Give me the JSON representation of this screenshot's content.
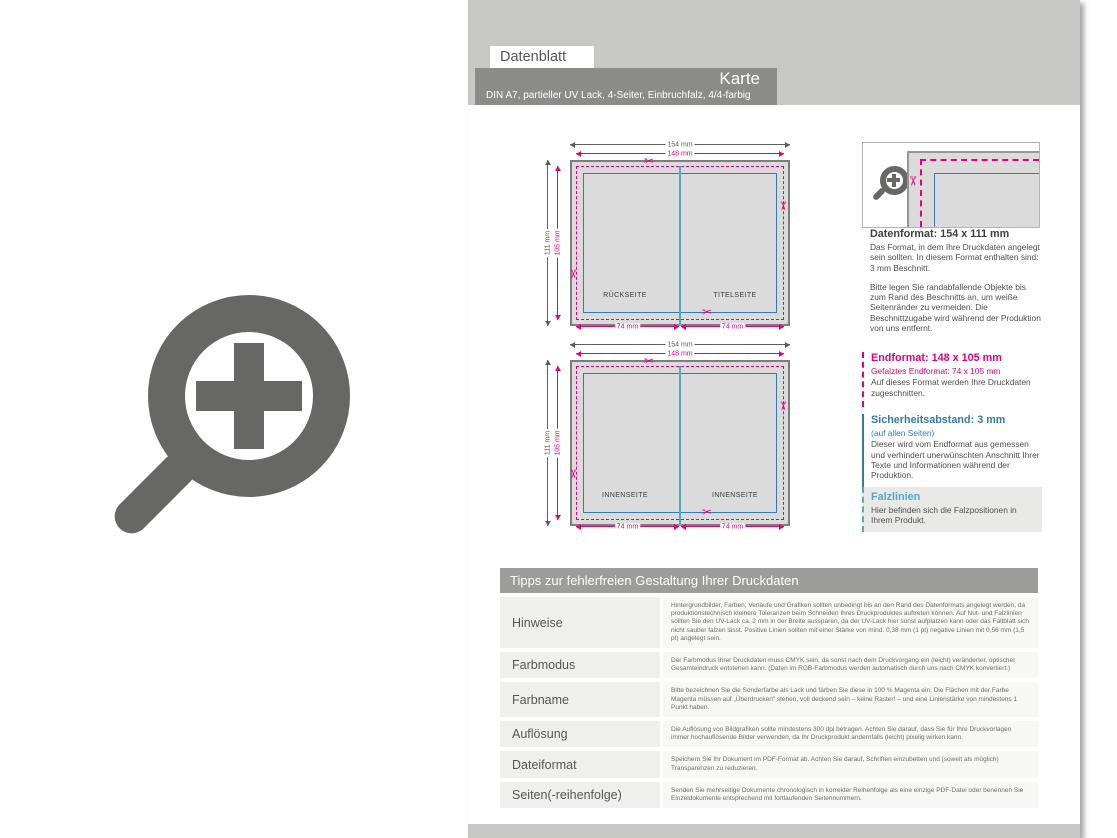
{
  "header": {
    "tab": "Datenblatt",
    "title": "Karte",
    "subtitle": "DIN A7, partieller UV Lack, 4-Seiter, Einbruchfalz, 4/4-farbig"
  },
  "icons": {
    "scissors": "✂"
  },
  "colors": {
    "magenta": "#e5007d",
    "safety_blue": "#3579b8",
    "fold_blue": "#54a7cb",
    "band_gray": "#c7c7c6",
    "header_gray": "#8b8b8a",
    "icon_gray": "#676766"
  },
  "diagrams": [
    {
      "dim_outer_w": "154 mm",
      "dim_inner_w": "148 mm",
      "dim_outer_h": "111 mm",
      "dim_inner_h": "105 mm",
      "dim_half_left": "74 mm",
      "dim_half_right": "74 mm",
      "label_left": "RÜCKSEITE",
      "label_right": "TITELSEITE"
    },
    {
      "dim_outer_w": "154 mm",
      "dim_inner_w": "148 mm",
      "dim_outer_h": "111 mm",
      "dim_inner_h": "105 mm",
      "dim_half_left": "74 mm",
      "dim_half_right": "74 mm",
      "label_left": "INNENSEITE",
      "label_right": "INNENSEITE"
    }
  ],
  "info": {
    "datenformat": {
      "heading": "Datenformat: 154 x 111 mm",
      "p1": "Das Format, in dem Ihre Druckdaten angelegt sein sollten. In diesem Format enthalten sind: 3 mm Beschnitt.",
      "p2": "Bitte legen Sie randabfallende Objekte bis zum Rand des Beschnitts an, um weiße Seitenränder zu vermeiden. Die Beschnittzugabe wird während der Produktion von uns entfernt."
    },
    "endformat": {
      "heading": "Endformat: 148 x 105 mm",
      "sub": "Gefalztes Endformat: 74 x 105 mm",
      "body": "Auf dieses Format werden Ihre Druckdaten zugeschnitten."
    },
    "sicherheitsabstand": {
      "heading": "Sicherheitsabstand: 3 mm",
      "sub": "(auf allen Seiten)",
      "body": "Dieser wird vom Endformat aus gemessen und verhindert unerwünschten Anschnitt Ihrer Texte und Informationen während der Produktion."
    },
    "falzlinien": {
      "heading": "Falzlinien",
      "body": "Hier befinden sich die Falzpositionen in Ihrem Produkt."
    }
  },
  "tips": {
    "title": "Tipps zur fehlerfreien Gestaltung Ihrer Druckdaten",
    "rows": [
      {
        "label": "Hinweise",
        "text": "Hintergrundbilder, Farben, Verläufe und Grafiken sollten unbedingt bis an den Rand des Datenformats angelegt werden, da produktionstechnisch kleinere Toleranzen beim Schneiden Ihres Druckproduktes auftreten können. Auf Nut- und Falzlinien sollten Sie den UV-Lack ca. 2 mm in der Breite aussparen, da der UV-Lack hier sonst aufplatzen kann oder das Faltblatt sich nicht sauber falzen lässt. Positive Linien sollten mit einer Stärke von mind. 0,38 mm (1 pt) negative Linien mit 0,56 mm (1,5 pt) angelegt sein."
      },
      {
        "label": "Farbmodus",
        "text": "Der Farbmodus Ihrer Druckdaten muss CMYK sein, da sonst nach dem Druckvorgang ein (leicht) veränderter, optischer Gesamteindruck entstehen kann. (Daten im RGB-Farbmodus werden automatisch durch uns nach CMYK konvertiert.)"
      },
      {
        "label": "Farbname",
        "text": "Bitte bezeichnen Sie die Sonderfarbe als Lack und färben Sie diese in 100 % Magenta ein. Die Flächen mit der Farbe Magenta müssen auf „Überdrucken“ stehen, voll deckend sein – keine Raster! – und eine Linienstärke von mindestens 1 Punkt haben."
      },
      {
        "label": "Auflösung",
        "text": "Die Auflösung von Bildgrafiken sollte mindestens 300 dpi betragen. Achten Sie darauf, dass Sie für Ihre Druckvorlagen immer hochauflösende Bilder verwenden, da Ihr Druckprodukt andernfalls (leicht) pixelig wirken kann."
      },
      {
        "label": "Dateiformat",
        "text": "Speichern Sie Ihr Dokument im PDF-Format ab. Achten Sie darauf, Schriften einzubetten und (soweit als möglich) Transparenzen zu reduzieren."
      },
      {
        "label": "Seiten(-reihenfolge)",
        "text": "Senden Sie mehrseitige Dokumente chronologisch in korrekter Reihenfolge als eine einzige PDF-Datei oder benennen Sie Einzeldokumente entsprechend mit fortlaufenden Seitennummern."
      }
    ]
  }
}
